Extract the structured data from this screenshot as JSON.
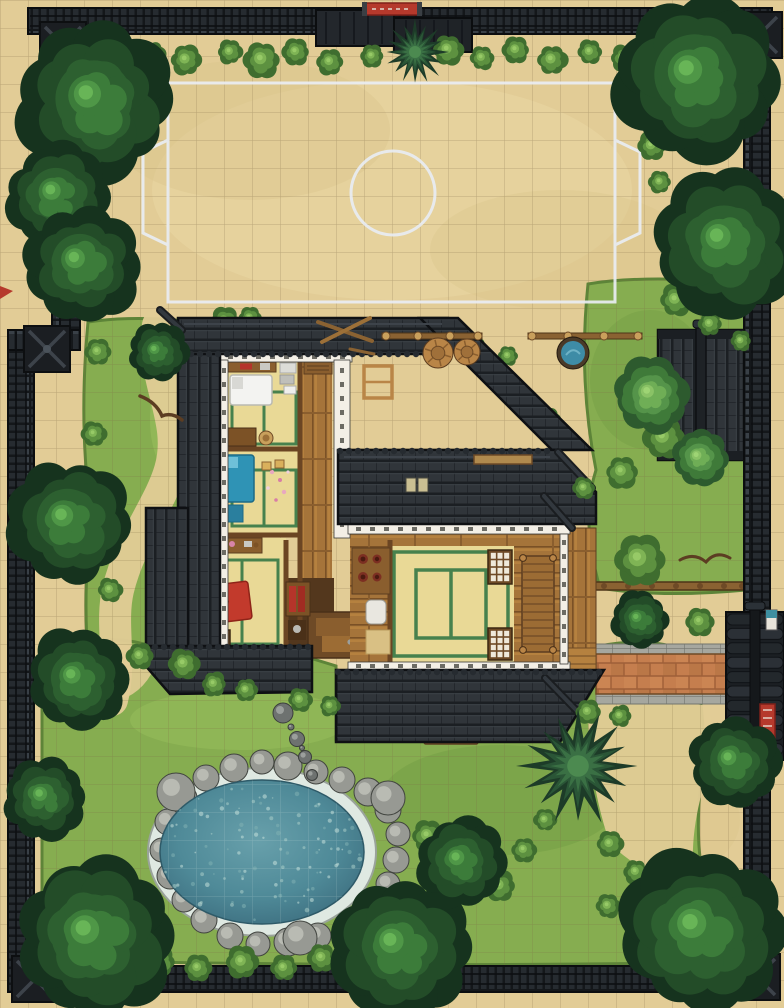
{
  "meta": {
    "alt": "Top-down battle map of a walled Japanese dojo compound with training yard, house, garden and pond"
  },
  "colors": {
    "ground": "#e2cc96",
    "grid": "#7e6a45",
    "field_line": "#e9edf3",
    "wall_dark": "#14171a",
    "wall_plank": "#262b30",
    "roof": "#30353a",
    "wood": "#a5743a",
    "tatami": "#e9d996",
    "tatami_green": "#3f7d4a",
    "water": "#4f8a98",
    "rock": "#979993",
    "brick": "#c57e4e",
    "accent_red": "#b5392c",
    "futon_white": "#f3f3f1",
    "futon_blue": "#2f93b5",
    "futon_red": "#c23a2c",
    "grass": "#86ad50",
    "tree_dark": "#16331e"
  },
  "scene": {
    "trees": [
      [
        97,
        102,
        80
      ],
      [
        58,
        196,
        54
      ],
      [
        82,
        264,
        58
      ],
      [
        158,
        352,
        30
      ],
      [
        698,
        78,
        84
      ],
      [
        727,
        244,
        74
      ],
      [
        70,
        522,
        64
      ],
      [
        78,
        680,
        52
      ],
      [
        95,
        938,
        84
      ],
      [
        400,
        948,
        72
      ],
      [
        702,
        932,
        86
      ],
      [
        734,
        762,
        46
      ],
      [
        462,
        862,
        46
      ],
      [
        45,
        798,
        42
      ],
      [
        640,
        620,
        30
      ]
    ],
    "light_trees": [
      [
        652,
        395,
        38
      ],
      [
        700,
        458,
        28
      ]
    ],
    "pines": [
      [
        415,
        52,
        30
      ],
      [
        578,
        766,
        54
      ]
    ],
    "bushes_under": [
      [
        225,
        322,
        15
      ],
      [
        250,
        318,
        11
      ],
      [
        300,
        344,
        10
      ],
      [
        432,
        336,
        10
      ],
      [
        472,
        344,
        12
      ],
      [
        508,
        356,
        10
      ],
      [
        548,
        420,
        12
      ],
      [
        568,
        486,
        12
      ]
    ],
    "bushes": [
      [
        118,
        58,
        16
      ],
      [
        152,
        54,
        13
      ],
      [
        186,
        60,
        15
      ],
      [
        230,
        52,
        12
      ],
      [
        262,
        60,
        18
      ],
      [
        296,
        52,
        13
      ],
      [
        330,
        62,
        13
      ],
      [
        372,
        56,
        11
      ],
      [
        448,
        50,
        15
      ],
      [
        482,
        58,
        12
      ],
      [
        516,
        50,
        13
      ],
      [
        552,
        60,
        15
      ],
      [
        590,
        52,
        12
      ],
      [
        624,
        58,
        13
      ],
      [
        652,
        146,
        14
      ],
      [
        660,
        182,
        11
      ],
      [
        98,
        352,
        13
      ],
      [
        94,
        434,
        12
      ],
      [
        110,
        590,
        12
      ],
      [
        140,
        656,
        13
      ],
      [
        184,
        664,
        15
      ],
      [
        214,
        684,
        12
      ],
      [
        246,
        690,
        11
      ],
      [
        300,
        700,
        12
      ],
      [
        330,
        706,
        10
      ],
      [
        664,
        438,
        20
      ],
      [
        622,
        472,
        16
      ],
      [
        640,
        560,
        26
      ],
      [
        700,
        622,
        14
      ],
      [
        676,
        300,
        16
      ],
      [
        710,
        324,
        12
      ],
      [
        741,
        341,
        10
      ],
      [
        160,
        962,
        15
      ],
      [
        198,
        968,
        13
      ],
      [
        242,
        962,
        16
      ],
      [
        284,
        968,
        13
      ],
      [
        322,
        958,
        14
      ],
      [
        360,
        952,
        12
      ],
      [
        130,
        940,
        12
      ],
      [
        428,
        836,
        16
      ],
      [
        448,
        880,
        14
      ],
      [
        500,
        886,
        15
      ],
      [
        524,
        850,
        12
      ],
      [
        545,
        820,
        11
      ],
      [
        610,
        844,
        13
      ],
      [
        636,
        872,
        12
      ],
      [
        608,
        906,
        12
      ],
      [
        588,
        712,
        12
      ],
      [
        620,
        716,
        11
      ],
      [
        584,
        488,
        11
      ]
    ],
    "pond": {
      "cx": 262,
      "cy": 852,
      "rx": 112,
      "ry": 82,
      "water_rx": 102,
      "water_ry": 72
    },
    "pond_rocks": [
      [
        206,
        778,
        13
      ],
      [
        234,
        768,
        14
      ],
      [
        262,
        762,
        12
      ],
      [
        288,
        766,
        14
      ],
      [
        316,
        772,
        12
      ],
      [
        342,
        780,
        13
      ],
      [
        368,
        792,
        14
      ],
      [
        388,
        810,
        13
      ],
      [
        398,
        834,
        12
      ],
      [
        396,
        860,
        13
      ],
      [
        388,
        884,
        12
      ],
      [
        372,
        906,
        13
      ],
      [
        348,
        924,
        13
      ],
      [
        318,
        936,
        13
      ],
      [
        288,
        942,
        14
      ],
      [
        258,
        944,
        12
      ],
      [
        230,
        936,
        13
      ],
      [
        204,
        920,
        13
      ],
      [
        184,
        900,
        12
      ],
      [
        170,
        876,
        13
      ],
      [
        162,
        850,
        12
      ],
      [
        168,
        822,
        13
      ],
      [
        184,
        798,
        13
      ],
      [
        176,
        792,
        19
      ],
      [
        388,
        798,
        17
      ],
      [
        300,
        938,
        17
      ]
    ],
    "stepping_stones": [
      [
        283,
        713,
        10
      ],
      [
        297,
        739,
        7.5
      ],
      [
        305,
        757,
        6.5
      ],
      [
        312,
        775,
        5.5
      ],
      [
        291,
        727,
        3
      ],
      [
        302,
        748,
        2.5
      ]
    ],
    "barrels": [
      [
        438,
        353,
        15
      ],
      [
        467,
        352,
        13
      ]
    ],
    "tub": [
      573,
      353,
      16
    ],
    "rack_knobs": [
      [
        386,
        336
      ],
      [
        418,
        336
      ],
      [
        450,
        336
      ],
      [
        478,
        336
      ],
      [
        532,
        336
      ],
      [
        568,
        336
      ],
      [
        604,
        336
      ],
      [
        638,
        336
      ]
    ],
    "fence_posts": [
      580,
      604,
      628,
      652,
      676,
      700,
      724,
      742
    ],
    "scallop_rows": [
      {
        "x1": 182,
        "x2": 446,
        "y": 354,
        "step": 9
      },
      {
        "x1": 340,
        "x2": 552,
        "y": 451,
        "step": 9
      },
      {
        "x1": 338,
        "x2": 600,
        "y": 672,
        "step": 9
      },
      {
        "x1": 146,
        "x2": 310,
        "y": 647,
        "step": 9
      }
    ],
    "shoji": [
      {
        "x": 488,
        "y": 550,
        "w": 24,
        "h": 34,
        "cols": 3,
        "rows": 4
      },
      {
        "x": 488,
        "y": 628,
        "w": 24,
        "h": 32,
        "cols": 3,
        "rows": 4
      },
      {
        "x": 198,
        "y": 630,
        "w": 32,
        "h": 22,
        "cols": 4,
        "rows": 2
      }
    ],
    "stairs": {
      "x": 522,
      "y": 556,
      "w": 32,
      "h": 96,
      "step": 8
    },
    "speckle_count": 110
  }
}
